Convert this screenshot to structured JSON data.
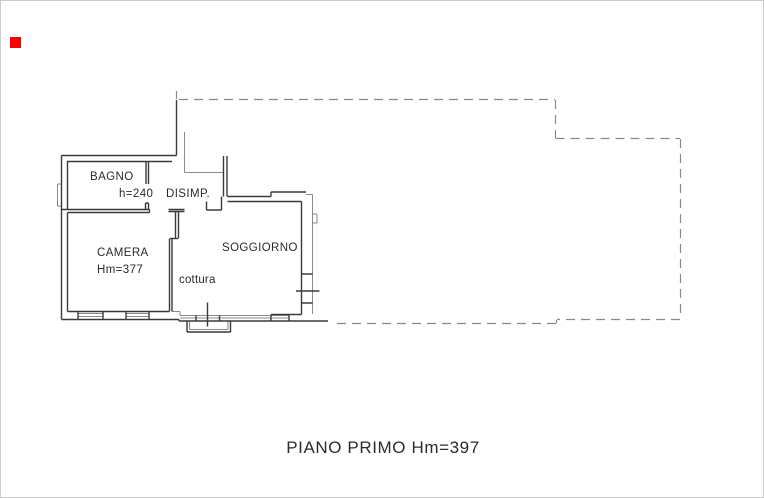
{
  "colors": {
    "wall": "#3a3a3a",
    "gray": "#8a8a8a",
    "marker": "#fd0000",
    "text": "#2b2b2b",
    "border": "#cccccc",
    "paper": "#ffffff"
  },
  "plan": {
    "labels": {
      "bagno": "BAGNO",
      "bagno_height": "h=240",
      "disimp": "DISIMP.",
      "camera": "CAMERA",
      "camera_height": "Hm=377",
      "soggiorno": "SOGGIORNO",
      "cottura": "cottura"
    }
  },
  "footer": {
    "title": "PIANO PRIMO Hm=397"
  }
}
